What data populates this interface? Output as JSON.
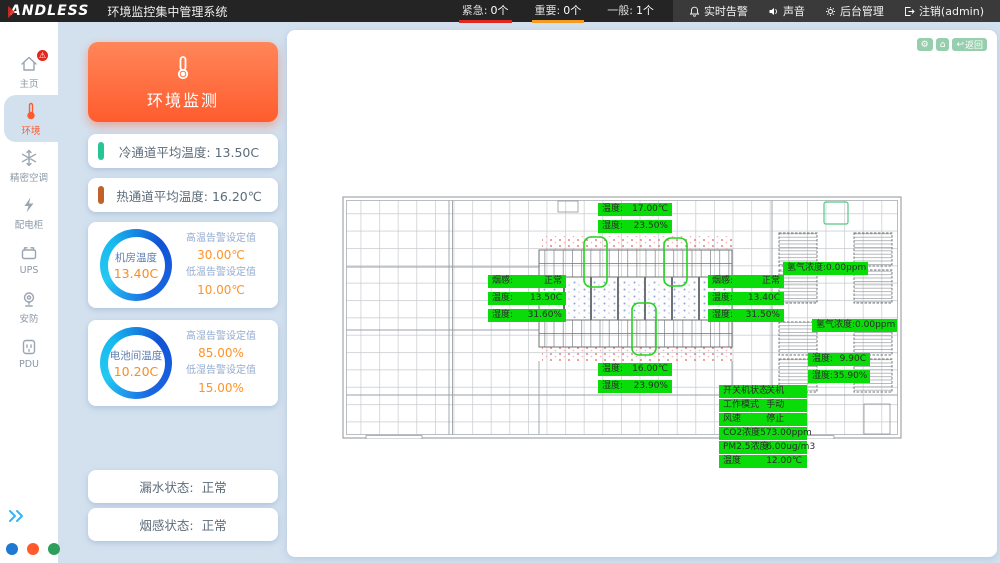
{
  "topbar": {
    "logo": "ANDLESS",
    "title": "环境监控集中管理系统",
    "alarms": [
      {
        "label": "紧急:",
        "count": "0个"
      },
      {
        "label": "重要:",
        "count": "0个"
      },
      {
        "label": "一般:",
        "count": "1个"
      }
    ],
    "actions": [
      {
        "label": "实时告警"
      },
      {
        "label": "声音"
      },
      {
        "label": "后台管理"
      },
      {
        "label": "注销(admin)"
      }
    ]
  },
  "sidebar": {
    "items": [
      {
        "label": "主页"
      },
      {
        "label": "环境"
      },
      {
        "label": "精密空调"
      },
      {
        "label": "配电柜"
      },
      {
        "label": "UPS"
      },
      {
        "label": "安防"
      },
      {
        "label": "PDU"
      }
    ]
  },
  "panel": {
    "header": "环境监测",
    "cold": {
      "label": "冷通道平均温度:",
      "value": "13.50C"
    },
    "hot": {
      "label": "热通道平均温度:",
      "value": "16.20℃"
    },
    "room": {
      "name": "机房温度",
      "value": "13.40C",
      "high_label": "高温告警设定值",
      "high_value": "30.00℃",
      "low_label": "低温告警设定值",
      "low_value": "10.00℃"
    },
    "battery": {
      "name": "电池间温度",
      "value": "10.20C",
      "high_label": "高湿告警设定值",
      "high_value": "85.00%",
      "low_label": "低湿告警设定值",
      "low_value": "15.00%"
    },
    "leak": {
      "label": "漏水状态:",
      "value": "正常"
    },
    "smoke": {
      "label": "烟感状态:",
      "value": "正常"
    }
  },
  "canvas": {
    "back_label": "返回",
    "map": {
      "top": [
        {
          "k": "温度:",
          "v": "17.00℃"
        },
        {
          "k": "湿度:",
          "v": "23.50%"
        }
      ],
      "left_group": [
        {
          "k": "烟感:",
          "v": "正常"
        },
        {
          "k": "温度:",
          "v": "13.50C"
        },
        {
          "k": "湿度:",
          "v": "31.60%"
        }
      ],
      "right_group": [
        {
          "k": "烟感:",
          "v": "正常"
        },
        {
          "k": "温度:",
          "v": "13.40C"
        },
        {
          "k": "湿度:",
          "v": "31.50%"
        }
      ],
      "hydrogen_top": [
        {
          "k": "氢气浓度:",
          "v": "0.00ppm"
        }
      ],
      "hydrogen_bottom": [
        {
          "k": "氢气浓度:",
          "v": "0.00ppm"
        }
      ],
      "bottom_mid": [
        {
          "k": "温度:",
          "v": "16.00℃"
        },
        {
          "k": "湿度:",
          "v": "23.90%"
        }
      ],
      "right_small": [
        {
          "k": "温度:",
          "v": "9.90C"
        },
        {
          "k": "湿度:",
          "v": "35.90%"
        }
      ],
      "fresh_air": [
        {
          "k": "开关机状态",
          "v": "关机"
        },
        {
          "k": "工作模式",
          "v": "手动"
        },
        {
          "k": "风速",
          "v": "停止"
        },
        {
          "k": "CO2浓度",
          "v": "573.00ppm"
        },
        {
          "k": "PM2.5浓度",
          "v": "6.00ug/m3"
        },
        {
          "k": "温度",
          "v": "12.00℃"
        }
      ]
    }
  },
  "colors": {
    "accent_orange": "#ff5c2e",
    "alarm_red": "#e0281e",
    "alarm_orange": "#f59a23",
    "label_green": "#0adc0a",
    "ring_blue": "#1253d6",
    "ring_cyan": "#24c8f2"
  }
}
